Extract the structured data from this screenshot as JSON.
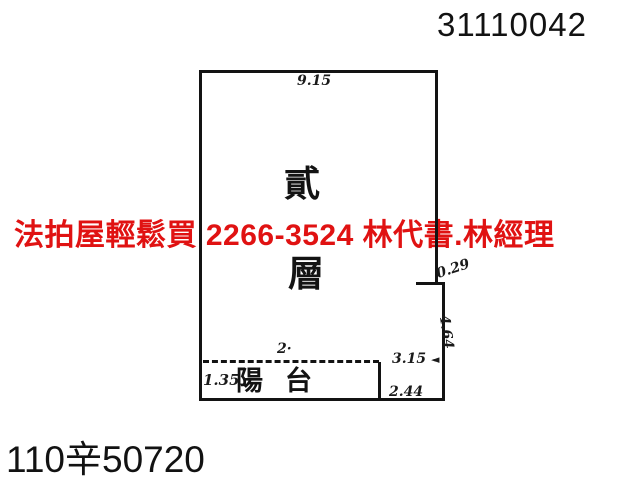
{
  "colors": {
    "background": "#ffffff",
    "ink": "#131313",
    "ad_red": "#e01212"
  },
  "header": {
    "doc_number": "31110042"
  },
  "footer": {
    "case_number": "110辛50720"
  },
  "ad_overlay": {
    "text": "法拍屋輕鬆買  2266-3524  林代書.林經理"
  },
  "floorplan": {
    "room_label_char1": "貳",
    "room_label_char2": "層",
    "balcony_label": "陽台",
    "dimensions": {
      "top_width": "9.15",
      "right_step": "0.29",
      "right_lower_height": "4.64",
      "inner_width": "3.15",
      "inner_arrow": "◄",
      "balcony_right_height": "2.44",
      "balcony_top": "2·",
      "balcony_left_height": "1.35"
    }
  }
}
